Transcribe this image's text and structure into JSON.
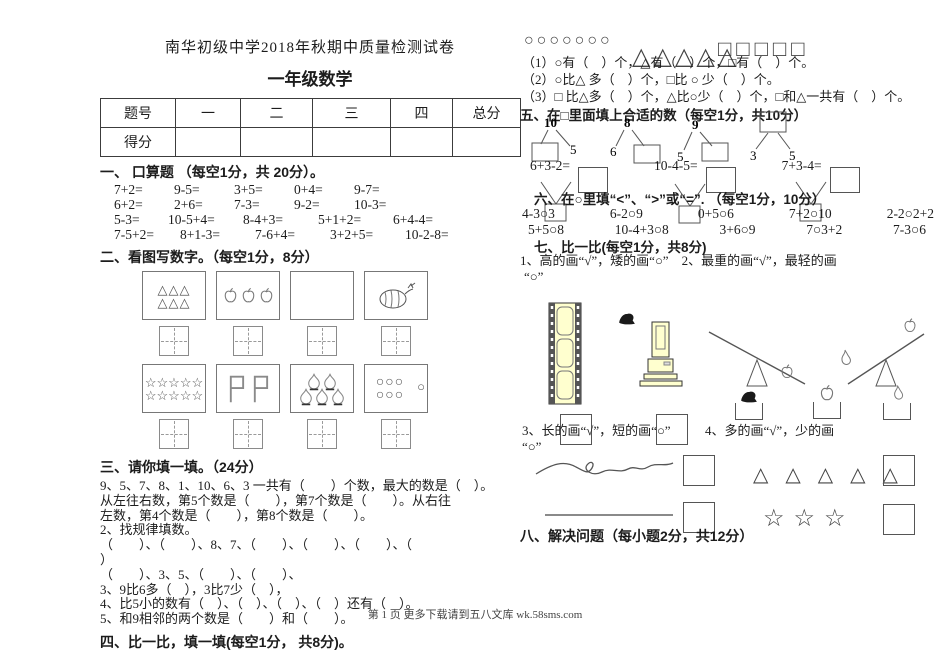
{
  "page": {
    "title": "南华初级中学2018年秋期中质量检测试卷",
    "subtitle": "一年级数学",
    "footer": "第 1 页 更多下载请到五八文库 wk.58sms.com"
  },
  "score_table": {
    "headers": [
      "题号",
      "一",
      "二",
      "三",
      "四",
      "总分"
    ],
    "score_label": "得分"
  },
  "sec1": {
    "heading": "一、 口算题 （每空1分，共 20分）。",
    "row1": [
      "7+2=",
      "9-5=",
      "3+5=",
      "0+4=",
      "9-7="
    ],
    "row2": [
      "6+2=",
      "2+6=",
      "7-3=",
      "9-2=",
      "10-3="
    ],
    "row3": [
      "5-3=",
      "10-5+4=",
      "8-4+3=",
      "5+1+2=",
      "6+4-4="
    ],
    "row4": [
      "7-5+2=",
      "8+1-3=",
      "7-6+4=",
      "3+2+5=",
      "10-2-8="
    ]
  },
  "sec2": {
    "heading": "二、看图写数字。（每空1分，8分）",
    "tri_row": "△△△",
    "stars_row": "☆☆☆☆☆",
    "circ_row": "○○○",
    "circ_extra": "○"
  },
  "sec3": {
    "heading": "三、请你填一填。（24分）",
    "lines": [
      "9、5、7、8、1、10、6、3 一共有（　　）个数，最大的数是（　）。",
      "从左往右数，第5个数是（　　），第7个数是（　　）。从右往",
      "左数，第4个数是（　　），第8个数是（　　）。",
      "2、找规律填数。",
      "（　　）、（　　）、8、7、（　　）、（　　）、（　　）、（",
      "）",
      "（　　）、3、5、（　　）、（　　）、",
      "3、9比6多（　），3比7少（　），",
      "4、比5小的数有（　）、（　）、（　）、（　）还有（　）。",
      "5、和9相邻的两个数是（　　）和（　　）。"
    ]
  },
  "sec4": {
    "heading": "四、比一比，填一填(每空1分， 共8分)。"
  },
  "right": {
    "circles": "○○○○○○○",
    "triangles": "△△△△△",
    "squares": "□□□□□",
    "q_lines": [
      "（1）○有（　）个，△有（　）个，□有（　）个。",
      "（2）○比△ 多（　）个，□比 ○ 少（　）个。",
      "（3）□ 比△多（　）个，△比○少（　）个，□和△一共有（　）个。"
    ]
  },
  "sec5": {
    "heading": "五、在□里面填上合适的数（每空1分，共10分）",
    "bonds": [
      {
        "top": "10",
        "right": "5"
      },
      {
        "top": "8",
        "left": "6"
      },
      {
        "top": "9",
        "left": "5"
      },
      {
        "left": "3",
        "right": "5"
      }
    ],
    "equations": [
      "6+3-2=",
      "10-4-5=",
      "7+3-4="
    ]
  },
  "sec6": {
    "heading": "六、在○里填“<”、“>”或“=”. （每空1分，10分）",
    "row1": [
      "4-3○3",
      "6-2○9",
      "0+5○6",
      "7+2○10",
      "2-2○2+2"
    ],
    "row2": [
      "5+5○8",
      "10-4+3○8",
      "3+6○9",
      "7○3+2",
      "7-3○6"
    ]
  },
  "sec7": {
    "heading": "七、比一比(每空1分，共8分)",
    "line1": "1、高的画“√”，矮的画“○”　2、最重的画“√”，最轻的画",
    "line1b": "“○”",
    "q3": "3、长的画“√”，短的画“○”",
    "q4": "4、多的画“√”，少的画",
    "q4b": "“○”",
    "triangles": "△ △ △ △ △",
    "stars": "☆☆☆"
  },
  "sec8": {
    "heading": "八、解决问题（每小题2分，共12分）"
  }
}
